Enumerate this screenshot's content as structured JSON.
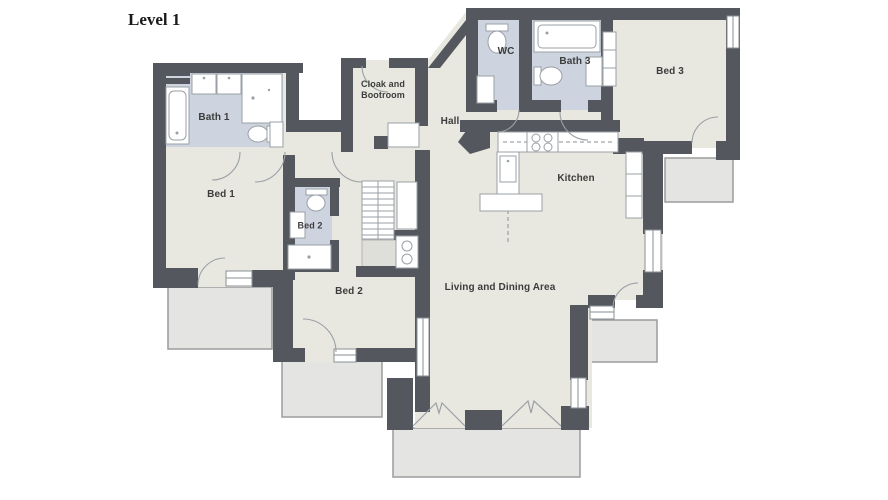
{
  "title": "Level 1",
  "plan": {
    "rooms": {
      "bath1": {
        "label": "Bath 1"
      },
      "bed1": {
        "label": "Bed 1"
      },
      "bed2_ensuite": {
        "label": "Bed 2"
      },
      "bed2": {
        "label": "Bed 2"
      },
      "cloak": {
        "label": "Cloak and Bootroom"
      },
      "hall": {
        "label": "Hall"
      },
      "wc": {
        "label": "WC"
      },
      "bath3": {
        "label": "Bath 3"
      },
      "bed3": {
        "label": "Bed 3"
      },
      "kitchen": {
        "label": "Kitchen"
      },
      "living": {
        "label": "Living and Dining Area"
      }
    },
    "colors": {
      "wall": "#54575e",
      "room_fill": "#e9e8e0",
      "bathroom_fill": "#cdd4df",
      "balcony_fill": "#e4e4e2",
      "fixture_fill": "#ffffff"
    }
  }
}
